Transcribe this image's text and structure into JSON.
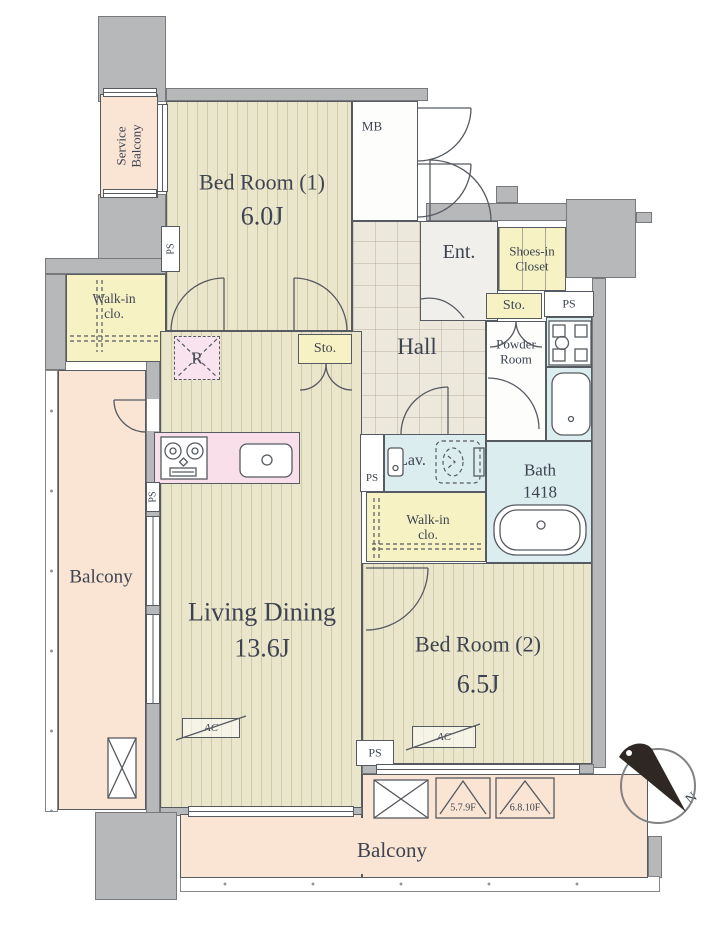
{
  "rooms": {
    "service_balcony": {
      "label": "Service\nBalcony"
    },
    "bedroom1": {
      "label": "Bed Room (1)",
      "size": "6.0J"
    },
    "meter_box": {
      "label": "MB"
    },
    "entrance": {
      "label": "Ent."
    },
    "shoes_in_closet": {
      "label": "Shoes-in\nCloset"
    },
    "storage": {
      "label": "Sto."
    },
    "pipe_space": {
      "label": "PS"
    },
    "powder_room": {
      "label": "Powder\nRoom"
    },
    "bath": {
      "label": "Bath",
      "size": "1418"
    },
    "hall": {
      "label": "Hall"
    },
    "lavatory": {
      "label": "Lav."
    },
    "walk_in_closet": {
      "label": "Walk-in\nclo."
    },
    "refrigerator_space": {
      "label": "R"
    },
    "living_dining": {
      "label": "Living Dining",
      "size": "13.6J"
    },
    "bedroom2": {
      "label": "Bed Room (2)",
      "size": "6.5J"
    },
    "balcony": {
      "label": "Balcony"
    }
  },
  "annotations": {
    "air_conditioner": "AC",
    "hatch_floors_a": "5.7.9F",
    "hatch_floors_b": "6.8.10F",
    "compass_north": "N"
  },
  "colors": {
    "wall": "#b7b8ba",
    "wood_floor": "#eae6cb",
    "tile_floor": "#ece8dc",
    "balcony": "#fae5d4",
    "closet": "#f6f2c4",
    "wet_area": "#dcedf0",
    "kitchen": "#f9dfe9",
    "line": "#565a61",
    "text": "#3d4350"
  }
}
